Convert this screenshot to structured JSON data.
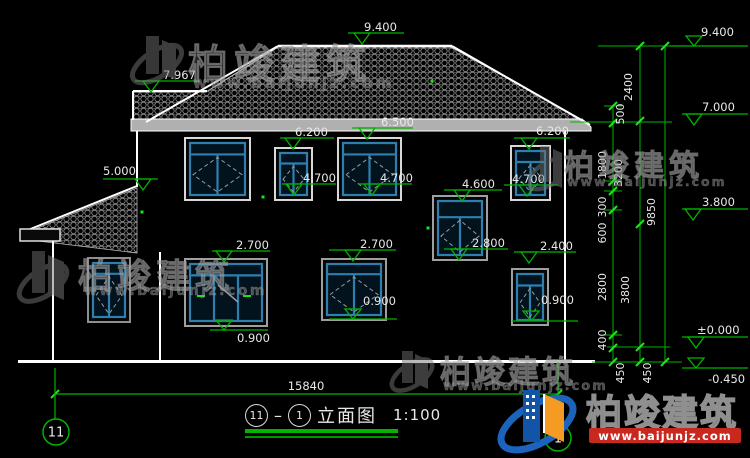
{
  "title": {
    "axis_left": "11",
    "separator": "–",
    "axis_right": "1",
    "name": "立面图",
    "scale": "1:100"
  },
  "watermark": {
    "cn": "柏竣建筑",
    "url": "www.baijunjz.com"
  },
  "logo": {
    "cn": "柏竣建筑",
    "url": "www.baijunjz.com"
  },
  "colors": {
    "background": "#000000",
    "line_white": "#ffffff",
    "eave_gray": "#b0b0b0",
    "dim_green": "#00b400",
    "tick_green": "#19e619",
    "text_white": "#e8e8e8",
    "window_blue": "#2e7fae",
    "logo_blue": "#1254a8",
    "logo_orange": "#f59a23",
    "logo_red": "#c8281e"
  },
  "drawing": {
    "total_width": {
      "label": "15840",
      "y": 394,
      "x1": 55,
      "x2": 558,
      "text_x": 306,
      "text_y": 390
    },
    "axis_bubbles": [
      {
        "label": "11",
        "cx": 56,
        "cy": 432,
        "r": 13,
        "ext": [
          55,
          368,
          419
        ]
      },
      {
        "label": "1",
        "cx": 558,
        "cy": 438,
        "r": 13,
        "ext": [
          558,
          362,
          425
        ]
      }
    ],
    "elevation_markers": [
      {
        "v": "9.400",
        "text": [
          364,
          31
        ],
        "line": [
          348,
          404,
          33
        ],
        "apex": 362,
        "up": false
      },
      {
        "v": "7.967",
        "text": [
          163,
          79
        ],
        "line": [
          135,
          200,
          81
        ],
        "apex": 151,
        "up": false
      },
      {
        "v": "5.000",
        "text": [
          103,
          175
        ],
        "line": [
          103,
          158,
          179
        ],
        "apex": 143,
        "up": false
      },
      {
        "v": "6.500",
        "text": [
          381,
          126
        ],
        "line": [
          352,
          413,
          128
        ],
        "apex": 367,
        "up": false
      },
      {
        "v": "6.200",
        "text": [
          295,
          136
        ],
        "line": [
          280,
          334,
          138
        ],
        "apex": 293,
        "up": false
      },
      {
        "v": "6.200",
        "text": [
          536,
          135
        ],
        "line": [
          514,
          570,
          138
        ],
        "apex": 529,
        "up": false
      },
      {
        "v": "4.700",
        "text": [
          303,
          182
        ],
        "line": [
          282,
          336,
          184
        ],
        "apex": 294,
        "up": false
      },
      {
        "v": "4.700",
        "text": [
          380,
          182
        ],
        "line": [
          359,
          412,
          184
        ],
        "apex": 372,
        "up": false
      },
      {
        "v": "4.700",
        "text": [
          512,
          183
        ],
        "line": [
          504,
          558,
          185
        ],
        "apex": 527,
        "up": false
      },
      {
        "v": "4.600",
        "text": [
          462,
          188
        ],
        "line": [
          444,
          502,
          190
        ],
        "apex": 462,
        "up": false
      },
      {
        "v": "2.800",
        "text": [
          472,
          247
        ],
        "line": [
          444,
          508,
          249
        ],
        "apex": 459,
        "up": false
      },
      {
        "v": "2.700",
        "text": [
          236,
          249
        ],
        "line": [
          212,
          270,
          251
        ],
        "apex": 224,
        "up": false
      },
      {
        "v": "2.700",
        "text": [
          360,
          248
        ],
        "line": [
          329,
          396,
          250
        ],
        "apex": 353,
        "up": false
      },
      {
        "v": "2.400",
        "text": [
          540,
          250
        ],
        "line": [
          514,
          576,
          252
        ],
        "apex": 529,
        "up": false
      },
      {
        "v": "0.900",
        "text": [
          237,
          342
        ],
        "line": [
          210,
          268,
          330
        ],
        "apex": 224,
        "up": true
      },
      {
        "v": "0.900",
        "text": [
          363,
          305
        ],
        "line": [
          329,
          397,
          319
        ],
        "apex": 353,
        "up": true
      },
      {
        "v": "0.900",
        "text": [
          541,
          304
        ],
        "line": [
          512,
          578,
          321
        ],
        "apex": 531,
        "up": true
      },
      {
        "v": "9.400",
        "text": [
          701,
          36
        ],
        "line": [
          670,
          748,
          46
        ],
        "apex": 694,
        "up": true
      },
      {
        "v": "7.000",
        "text": [
          702,
          111
        ],
        "line": [
          682,
          748,
          114
        ],
        "apex": 694,
        "up": false
      },
      {
        "v": "3.800",
        "text": [
          702,
          206
        ],
        "line": [
          682,
          748,
          209
        ],
        "apex": 693,
        "up": false
      },
      {
        "v": "±0.000",
        "text": [
          697,
          334
        ],
        "line": [
          682,
          748,
          337
        ],
        "apex": 696,
        "up": false
      },
      {
        "v": "-0.450",
        "text": [
          708,
          383
        ],
        "line": [
          682,
          748,
          368
        ],
        "apex": 696,
        "up": true
      }
    ],
    "chains": [
      {
        "x": 613,
        "y1": 106,
        "y2": 362,
        "ticks": [
          106,
          123,
          181,
          191,
          210,
          335,
          348,
          362
        ],
        "labels": [
          {
            "t": "500",
            "x": 624,
            "y": 114
          },
          {
            "t": "1800",
            "x": 606,
            "y": 165
          },
          {
            "t": "300",
            "x": 606,
            "y": 207
          },
          {
            "t": "600",
            "x": 606,
            "y": 233
          },
          {
            "t": "2800",
            "x": 606,
            "y": 287
          },
          {
            "t": "400",
            "x": 606,
            "y": 340
          },
          {
            "t": "450",
            "x": 624,
            "y": 373
          }
        ]
      },
      {
        "x": 640,
        "y1": 46,
        "y2": 362,
        "ticks": [
          46,
          121,
          224,
          347,
          362
        ],
        "labels": [
          {
            "t": "2400",
            "x": 632,
            "y": 87
          },
          {
            "t": "3200",
            "x": 622,
            "y": 173
          },
          {
            "t": "3800",
            "x": 629,
            "y": 290
          },
          {
            "t": "450",
            "x": 651,
            "y": 373
          }
        ]
      },
      {
        "x": 665,
        "y1": 46,
        "y2": 362,
        "ticks": [
          46,
          362
        ],
        "labels": [
          {
            "t": "9850",
            "x": 655,
            "y": 212
          }
        ]
      }
    ],
    "connector_lines": [
      [
        598,
        672,
        46
      ],
      [
        570,
        672,
        122
      ],
      [
        592,
        682,
        362
      ],
      [
        604,
        622,
        106
      ],
      [
        604,
        622,
        181
      ],
      [
        604,
        622,
        191
      ],
      [
        604,
        622,
        210
      ],
      [
        604,
        622,
        335
      ],
      [
        607,
        670,
        347
      ]
    ],
    "windows": [
      {
        "x": 185,
        "y": 138,
        "w": 65,
        "h": 62,
        "frame": "#d8d8d8",
        "transom": 0.22,
        "mull": 1,
        "diamond": true
      },
      {
        "x": 275,
        "y": 148,
        "w": 37,
        "h": 52,
        "frame": "#d8d8d8",
        "transom": 0.25,
        "mull": 1,
        "diamond": true
      },
      {
        "x": 338,
        "y": 138,
        "w": 63,
        "h": 62,
        "frame": "#d8d8d8",
        "transom": 0.22,
        "mull": 1,
        "diamond": true
      },
      {
        "x": 511,
        "y": 146,
        "w": 39,
        "h": 54,
        "frame": "#d8d8d8",
        "transom": 0.25,
        "mull": 1,
        "diamond": true
      },
      {
        "x": 433,
        "y": 196,
        "w": 54,
        "h": 64,
        "frame": "#9f9f9f",
        "transom": 0.3,
        "mull": 1,
        "diamond": true
      },
      {
        "x": 185,
        "y": 259,
        "w": 82,
        "h": 67,
        "frame": "#9f9f9f",
        "transom": 0.2,
        "mull": 2,
        "diamond": false,
        "extras": true
      },
      {
        "x": 322,
        "y": 259,
        "w": 64,
        "h": 61,
        "frame": "#9f9f9f",
        "transom": 0.2,
        "mull": 1,
        "diamond": true
      },
      {
        "x": 512,
        "y": 269,
        "w": 36,
        "h": 56,
        "frame": "#9f9f9f",
        "transom": 0.25,
        "mull": 1,
        "diamond": true
      },
      {
        "x": 88,
        "y": 258,
        "w": 42,
        "h": 64,
        "frame": "#8f8f8f",
        "transom": 0.2,
        "mull": 1,
        "diamond": true
      }
    ],
    "dots": [
      [
        432,
        81
      ],
      [
        263,
        197
      ],
      [
        428,
        228
      ],
      [
        142,
        212
      ]
    ]
  }
}
